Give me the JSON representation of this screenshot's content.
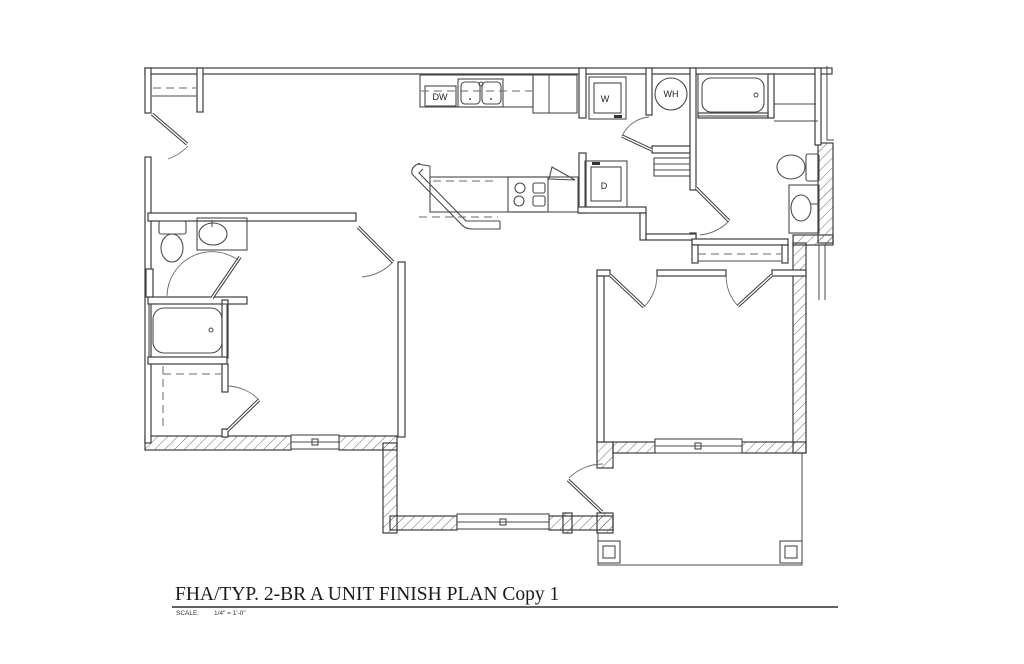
{
  "drawing": {
    "title": "FHA/TYP. 2-BR A UNIT FINISH PLAN Copy 1",
    "scale_label": "SCALE:",
    "scale_value": "1/4\" = 1'-0\"",
    "labels": {
      "dishwasher": "DW",
      "washer": "W",
      "water_heater": "WH",
      "dryer": "D"
    },
    "colors": {
      "line": "#3c3c3c",
      "background": "#ffffff"
    }
  }
}
